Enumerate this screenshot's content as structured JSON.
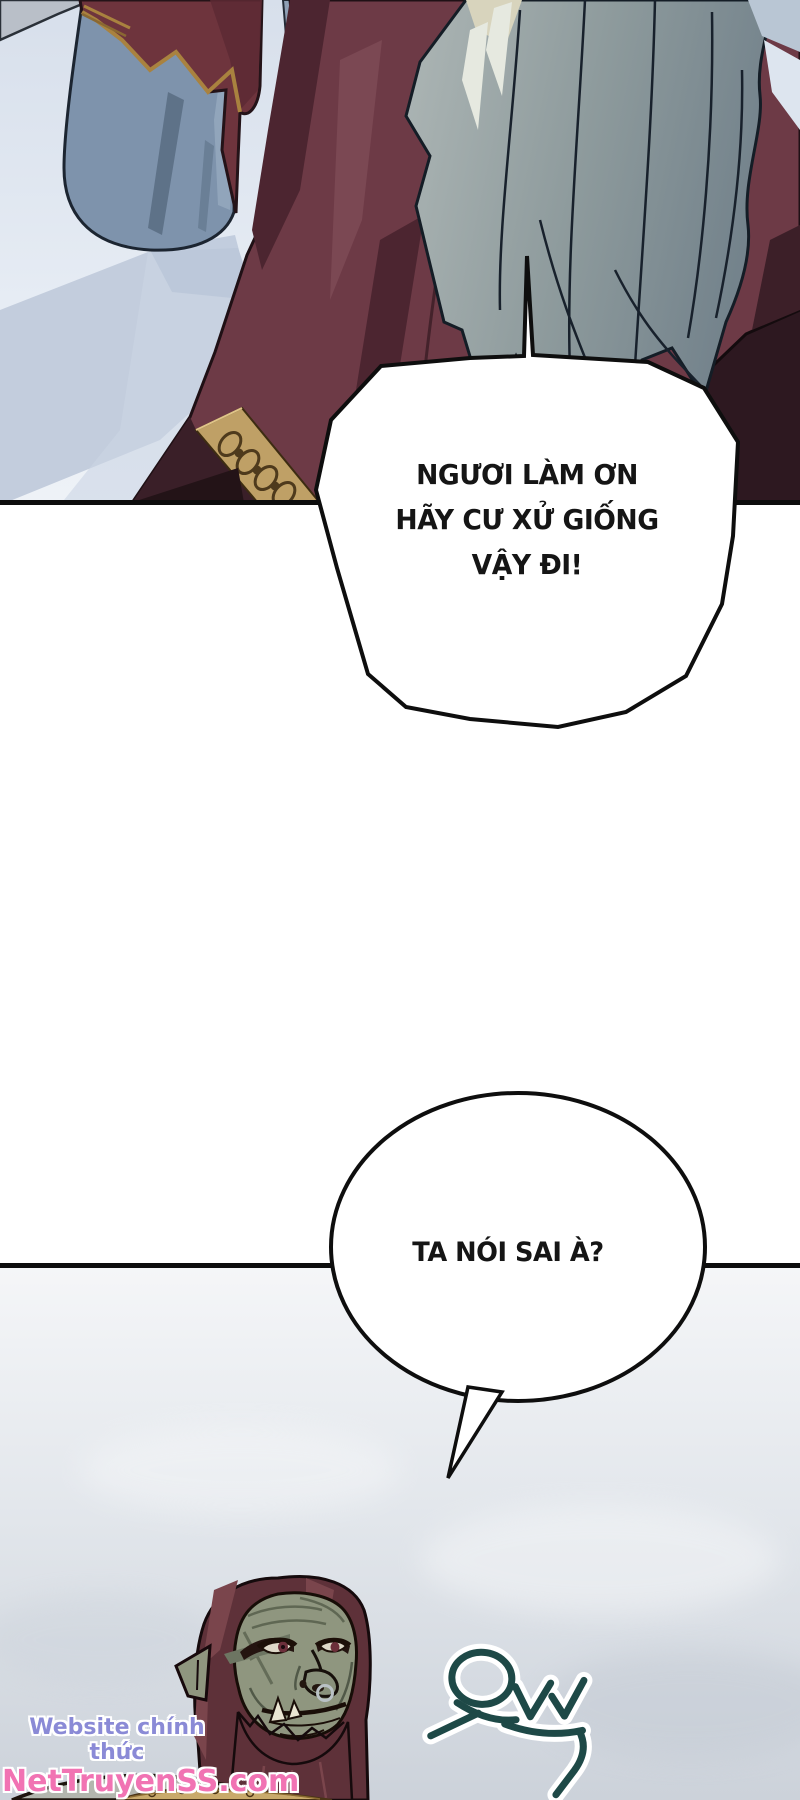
{
  "page": {
    "type": "manhwa-comic-page",
    "width": 800,
    "height": 1800,
    "background": "#ffffff"
  },
  "panels": [
    {
      "label": "top-panel",
      "divider_y": 505
    },
    {
      "label": "bottom-panel",
      "divider_y": 1265
    }
  ],
  "speech_bubbles": [
    {
      "style": "angular",
      "tail": "top",
      "lines": [
        "NGƯƠI LÀM ƠN",
        "HÃY CƯ XỬ GIỐNG",
        "VẬY ĐI!"
      ]
    },
    {
      "style": "round",
      "tail": "bottom-left",
      "lines": [
        "TA NÓI SAI À?"
      ]
    }
  ],
  "sfx": {
    "text": "으쓱",
    "color": "#1e4947",
    "outline_color": "#ffffff"
  },
  "watermark": {
    "line1": "Website chính thức",
    "line2": "NetTruyenSS.com",
    "line1_color": "#8a8ad6",
    "line2_color": "#f173b3"
  },
  "colors": {
    "panel_line": "#0d0d0d",
    "sky": "#dce3ee",
    "ground_shadow": "#c4cedf",
    "maroon_robe": "#6d3a46",
    "maroon_robe_dark": "#2d1820",
    "blue_robe": "#7e93ac",
    "red_cape": "#6e343d",
    "gold_trim": "#bfa066",
    "silver_hair": "#9aa6a8",
    "hair_highlight": "#e6e9e0",
    "orc_skin": "#8f967f",
    "orc_hair": "#5e3139",
    "bottom_bg": "#ccd2da"
  }
}
